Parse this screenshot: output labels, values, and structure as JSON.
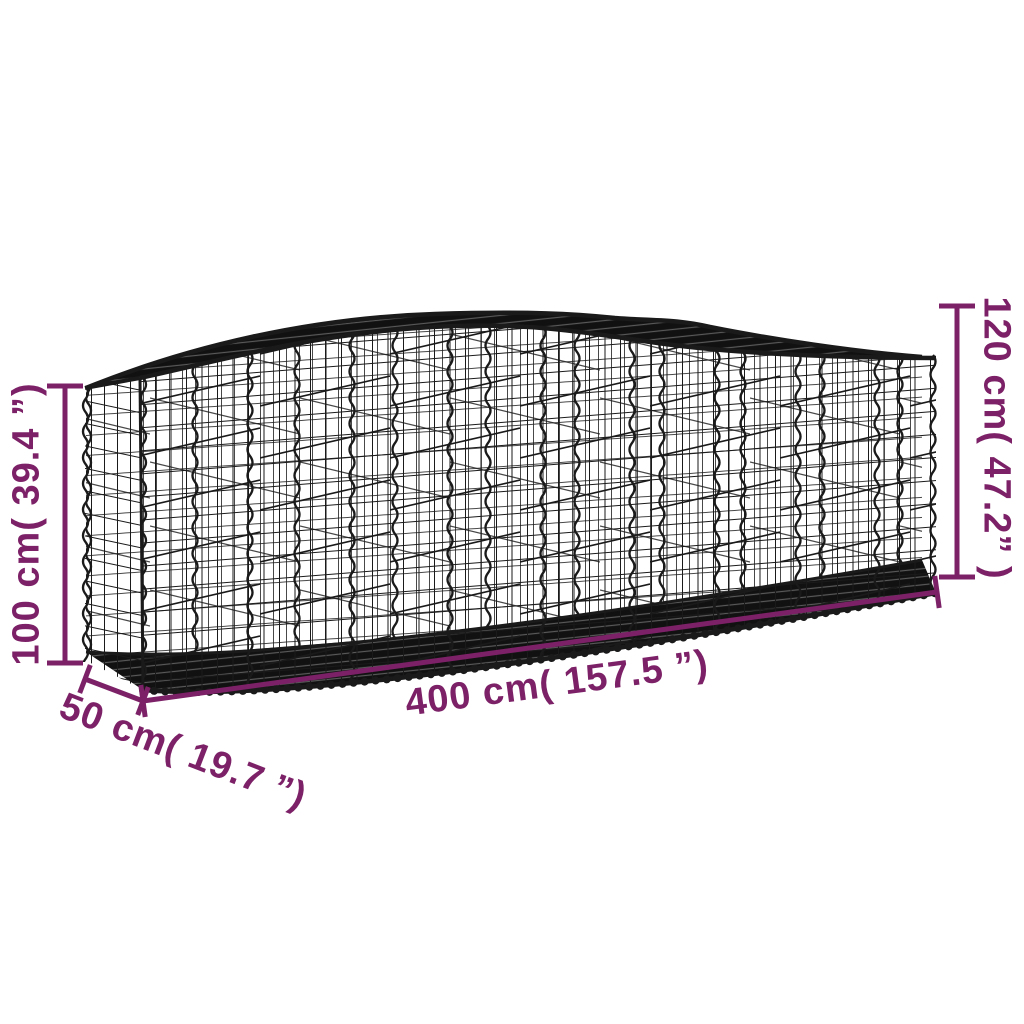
{
  "illustration": {
    "name": "arched-gabion-basket-wireframe",
    "description": "3D perspective line drawing of a long arched wire-mesh gabion basket with vertical spiral joiners",
    "wire_color": "#1a1a1a",
    "background": "#ffffff"
  },
  "accent_color": "#7C2167",
  "dimensions": {
    "height_left": {
      "label": "100 cm( 39.4 ”)",
      "cm": 100,
      "inches": 39.4,
      "placement": "vertical-left"
    },
    "height_right": {
      "label": "120 cm( 47.2” )",
      "cm": 120,
      "inches": 47.2,
      "placement": "vertical-right"
    },
    "length": {
      "label": "400 cm( 157.5 ”)",
      "cm": 400,
      "inches": 157.5,
      "placement": "bottom"
    },
    "depth": {
      "label": "50 cm( 19.7 ”)",
      "cm": 50,
      "inches": 19.7,
      "placement": "bottom-left-diagonal"
    }
  }
}
